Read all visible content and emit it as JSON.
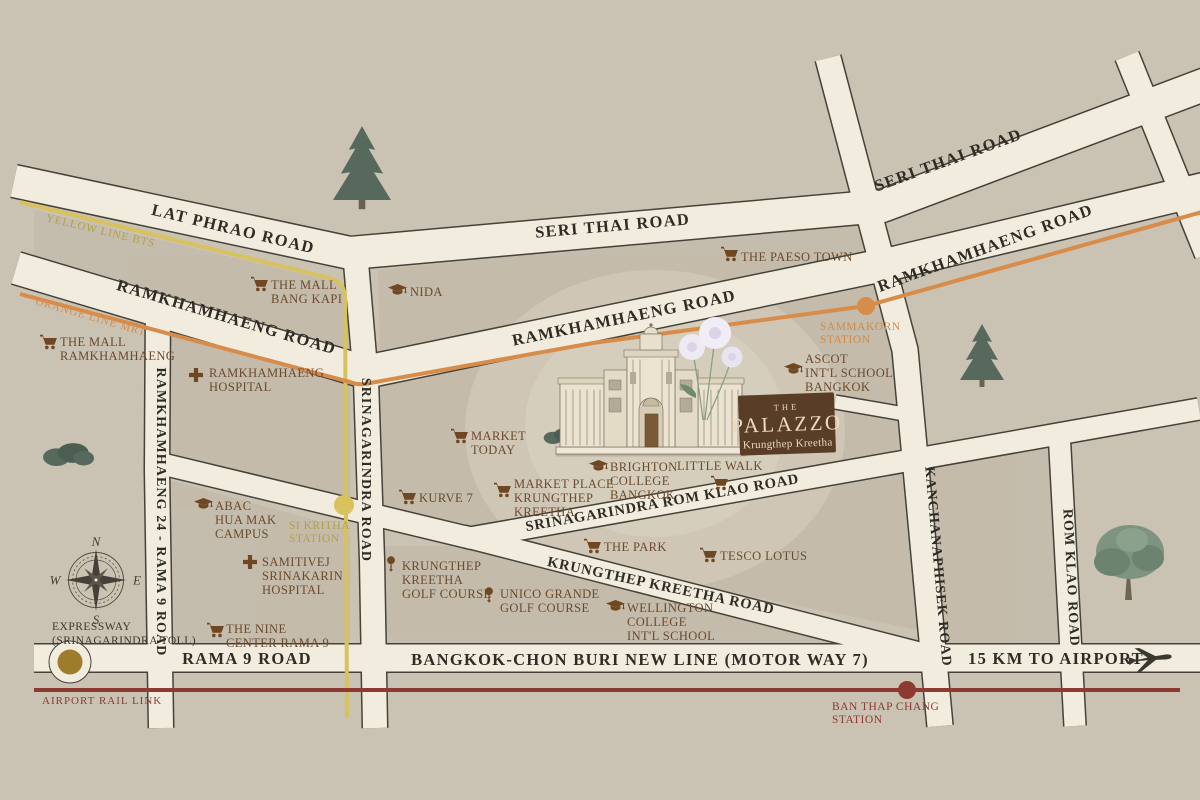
{
  "badge": {
    "prefix": "THE",
    "name": "PALAZZO",
    "subtitle": "Krungthep Kreetha"
  },
  "roads": {
    "latPhrao": "LAT PHRAO ROAD",
    "seriThaiWest": "SERI THAI ROAD",
    "seriThaiEast": "SERI THAI ROAD",
    "ramkhamhaengWest": "RAMKHAMHAENG ROAD",
    "ramkhamhaengCentral": "RAMKHAMHAENG ROAD",
    "ramkhamhaengEast": "RAMKHAMHAENG ROAD",
    "ramkhamhaeng24": "RAMKHAMHAENG 24 - RAMA 9 ROAD",
    "srinagarindra": "SRINAGARINDRA ROAD",
    "srinagarindraRomKlao": "SRINAGARINDRA ROM KLAO ROAD",
    "krungthepKreetha": "KRUNGTHEP KREETHA ROAD",
    "kanchanaphisek": "KANCHANAPHISEK ROAD",
    "romKlao": "ROM KLAO ROAD",
    "rama9": "RAMA 9 ROAD",
    "motorway": "BANGKOK-CHON BURI NEW LINE (MOTOR WAY 7)",
    "airportDistance": "15 KM TO AIRPORT"
  },
  "transit": {
    "yellowLine": {
      "label": "YELLOW LINE BTS"
    },
    "orangeLine": {
      "label": "ORANGE LINE MRT"
    },
    "airportRailLink": {
      "label": "AIRPORT RAIL LINK"
    }
  },
  "stations": {
    "siKritha": {
      "lines": [
        "SI KRITHA",
        "STATION"
      ]
    },
    "sammakorn": {
      "lines": [
        "SAMMAKORN",
        "STATION"
      ]
    },
    "banThapChang": {
      "lines": [
        "BAN THAP CHANG",
        "STATION"
      ]
    }
  },
  "expressway": {
    "lines": [
      "EXPRESSWAY",
      "(SRINAGARINDRA TOLL)"
    ]
  },
  "compass": {
    "n": "N",
    "e": "E",
    "s": "S",
    "w": "W"
  },
  "pois": [
    {
      "name": "The Mall Bang Kapi",
      "icon": "cart",
      "lines": [
        "THE MALL",
        "BANG KAPI"
      ]
    },
    {
      "name": "The Paeso Town",
      "icon": "cart",
      "lines": [
        "THE PAESO TOWN"
      ]
    },
    {
      "name": "NIDA",
      "icon": "grad",
      "lines": [
        "NIDA"
      ]
    },
    {
      "name": "The Mall Ramkhamhaeng",
      "icon": "cart",
      "lines": [
        "THE MALL",
        "RAMKHAMHAENG"
      ]
    },
    {
      "name": "Ramkhamhaeng Hospital",
      "icon": "cross",
      "lines": [
        "RAMKHAMHAENG",
        "HOSPITAL"
      ]
    },
    {
      "name": "Ascot Intl School Bangkok",
      "icon": "grad",
      "lines": [
        "ASCOT",
        "INT'L SCHOOL",
        "BANGKOK"
      ]
    },
    {
      "name": "Market Today",
      "icon": "cart",
      "lines": [
        "MARKET",
        "TODAY"
      ]
    },
    {
      "name": "Kurve 7",
      "icon": "cart",
      "lines": [
        "KURVE 7"
      ]
    },
    {
      "name": "Market Place Krungthep Kreetha",
      "icon": "cart",
      "lines": [
        "MARKET PLACE",
        "KRUNGTHEP",
        "KREETHA"
      ]
    },
    {
      "name": "Brighton College Bangkok",
      "icon": "grad",
      "lines": [
        "BRIGHTON",
        "COLLEGE",
        "BANGKOK"
      ]
    },
    {
      "name": "Little Walk",
      "icon": "cart",
      "lines": [
        "LITTLE WALK"
      ]
    },
    {
      "name": "ABAC Hua Mak Campus",
      "icon": "grad",
      "lines": [
        "ABAC",
        "HUA MAK",
        "CAMPUS"
      ]
    },
    {
      "name": "Samitivej Srinakarin Hospital",
      "icon": "cross",
      "lines": [
        "SAMITIVEJ",
        "SRINAKARIN",
        "HOSPITAL"
      ]
    },
    {
      "name": "Krungthep Kreetha Golf Course",
      "icon": "golf",
      "lines": [
        "KRUNGTHEP",
        "KREETHA",
        "GOLF COURSE"
      ]
    },
    {
      "name": "Unico Grande Golf Course",
      "icon": "golf",
      "lines": [
        "UNICO GRANDE",
        "GOLF COURSE"
      ]
    },
    {
      "name": "The Park",
      "icon": "cart",
      "lines": [
        "THE PARK"
      ]
    },
    {
      "name": "Tesco Lotus",
      "icon": "cart",
      "lines": [
        "TESCO LOTUS"
      ]
    },
    {
      "name": "Wellington College Intl School",
      "icon": "grad",
      "lines": [
        "WELLINGTON",
        "COLLEGE",
        "INT'L SCHOOL"
      ]
    },
    {
      "name": "The Nine Center Rama 9",
      "icon": "cart",
      "lines": [
        "THE NINE",
        "CENTER RAMA 9"
      ]
    }
  ],
  "colors": {
    "background": "#cac2b2",
    "roadFill": "#f2ecdf",
    "roadEdge": "#45423a",
    "yellowLine": "#d7c25f",
    "orangeLine": "#d88c49",
    "airportRailLink": "#8d3a33",
    "poiText": "#6b4a2d",
    "roadText": "#2e2c25",
    "badgeBackground": "#5a3d26",
    "badgeText": "#ecdcbd",
    "tollMarker": "#9d7d2b",
    "stationYellowText": "#b3a04a",
    "stationOrangeText": "#d28a45",
    "stationRedText": "#8d3a33"
  }
}
